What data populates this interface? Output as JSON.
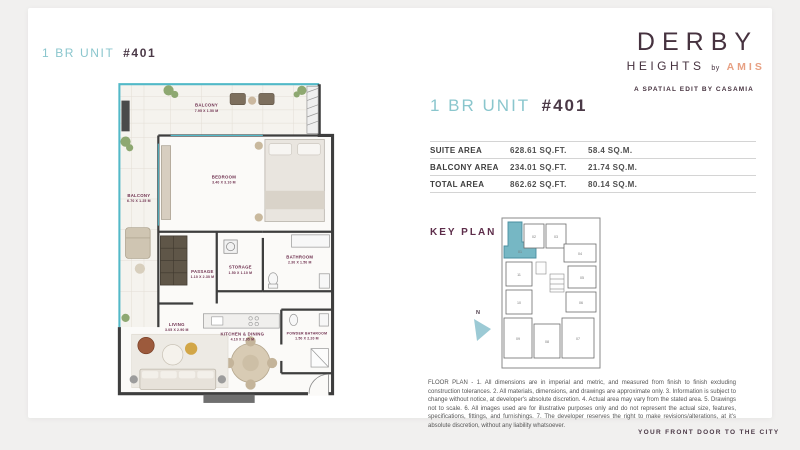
{
  "colors": {
    "accent_teal": "#8ac6cd",
    "brand_maroon": "#4b3947",
    "amis_orange": "#e7a083",
    "plan_label_maroon": "#6e2f4e",
    "keyplan_highlight_teal": "#76b7c4",
    "page_background": "#f1f0ef"
  },
  "floorplan": {
    "title": {
      "prefix": "1 BR UNIT",
      "number": "#401"
    },
    "rooms": [
      {
        "name": "BALCONY",
        "dims": "7.95 X 1.50 M"
      },
      {
        "name": "BEDROOM",
        "dims": "3.40 X 3.10 M"
      },
      {
        "name": "BALCONY",
        "dims": "6.70 X 1.25 M"
      },
      {
        "name": "BATHROOM",
        "dims": "2.30 X 1.50 M"
      },
      {
        "name": "PASSAGE",
        "dims": "1.10 X 2.30 M"
      },
      {
        "name": "STORAGE",
        "dims": "1.50 X 1.10 M"
      },
      {
        "name": "LIVING",
        "dims": "3.05 X 2.90 M"
      },
      {
        "name": "KITCHEN & DINING",
        "dims": "4.10 X 2.95 M"
      },
      {
        "name": "POWDER BATHROOM",
        "dims": "1.50 X 2.20 M"
      }
    ]
  },
  "brand": {
    "name": "DERBY",
    "heights": "HEIGHTS",
    "by": "by",
    "amis": "AMIS",
    "tagline": "A SPATIAL EDIT BY CASAMIA",
    "footer": "YOUR FRONT DOOR TO THE CITY"
  },
  "details": {
    "title": {
      "prefix": "1 BR UNIT",
      "number": "#401"
    },
    "area_table": {
      "rows": [
        {
          "label": "SUITE AREA",
          "sqft": "628.61 SQ.FT.",
          "sqm": "58.4 SQ.M."
        },
        {
          "label": "BALCONY AREA",
          "sqft": "234.01 SQ.FT.",
          "sqm": "21.74 SQ.M."
        },
        {
          "label": "TOTAL AREA",
          "sqft": "862.62 SQ.FT.",
          "sqm": "80.14 SQ.M."
        }
      ]
    },
    "key_plan": {
      "heading": "KEY PLAN",
      "north": "N",
      "highlighted_unit": "01",
      "units": [
        "01",
        "02",
        "03",
        "04",
        "05",
        "06",
        "07",
        "08",
        "09",
        "10",
        "11"
      ]
    },
    "disclaimer": "FLOOR PLAN - 1. All dimensions are in imperial and metric, and measured from finish to finish excluding construction tolerances. 2. All materials, dimensions, and drawings are approximate only. 3. Information is subject to change without notice, at developer's absolute discretion. 4. Actual area may vary from the stated area. 5. Drawings not to scale. 6. All images used are for illustrative purposes only and do not represent the actual size, features, specifications, fittings, and furnishings. 7. The developer reserves the right to make revisions/alterations, at it's absolute discretion, without any liability whatsoever."
  }
}
